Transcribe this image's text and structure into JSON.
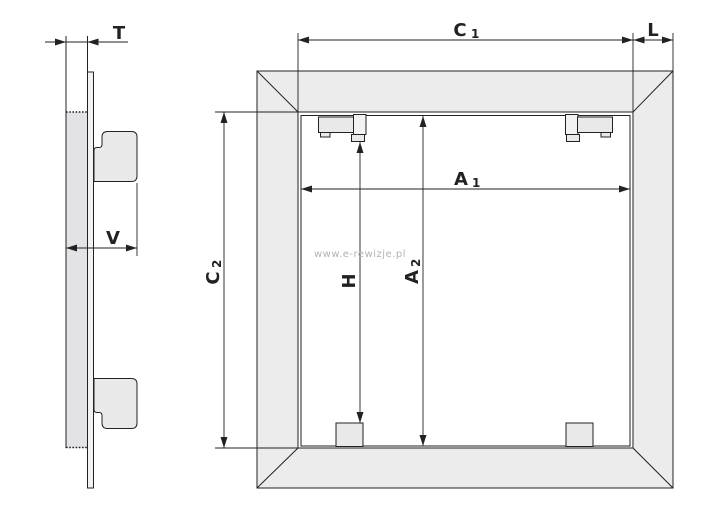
{
  "diagram": {
    "title": "access-panel-dimension-drawing",
    "watermark": "www.e-rewizje.pl",
    "dimensions": {
      "t": {
        "label": "T"
      },
      "v": {
        "label": "V"
      },
      "l": {
        "label": "L"
      },
      "h": {
        "label": "H"
      },
      "c1": {
        "main": "C",
        "sub": "1"
      },
      "c2": {
        "main": "C",
        "sub": "2"
      },
      "a1": {
        "main": "A",
        "sub": "1"
      },
      "a2": {
        "main": "A",
        "sub": "2"
      }
    },
    "colors": {
      "line": "#222222",
      "frame_fill": "#ececec",
      "panel_fill": "#e3e3e5",
      "plate_fill": "#f2f2f2",
      "bracket_fill": "#e9e9e9",
      "watermark": "#b3b3b3",
      "background": "#ffffff"
    }
  }
}
